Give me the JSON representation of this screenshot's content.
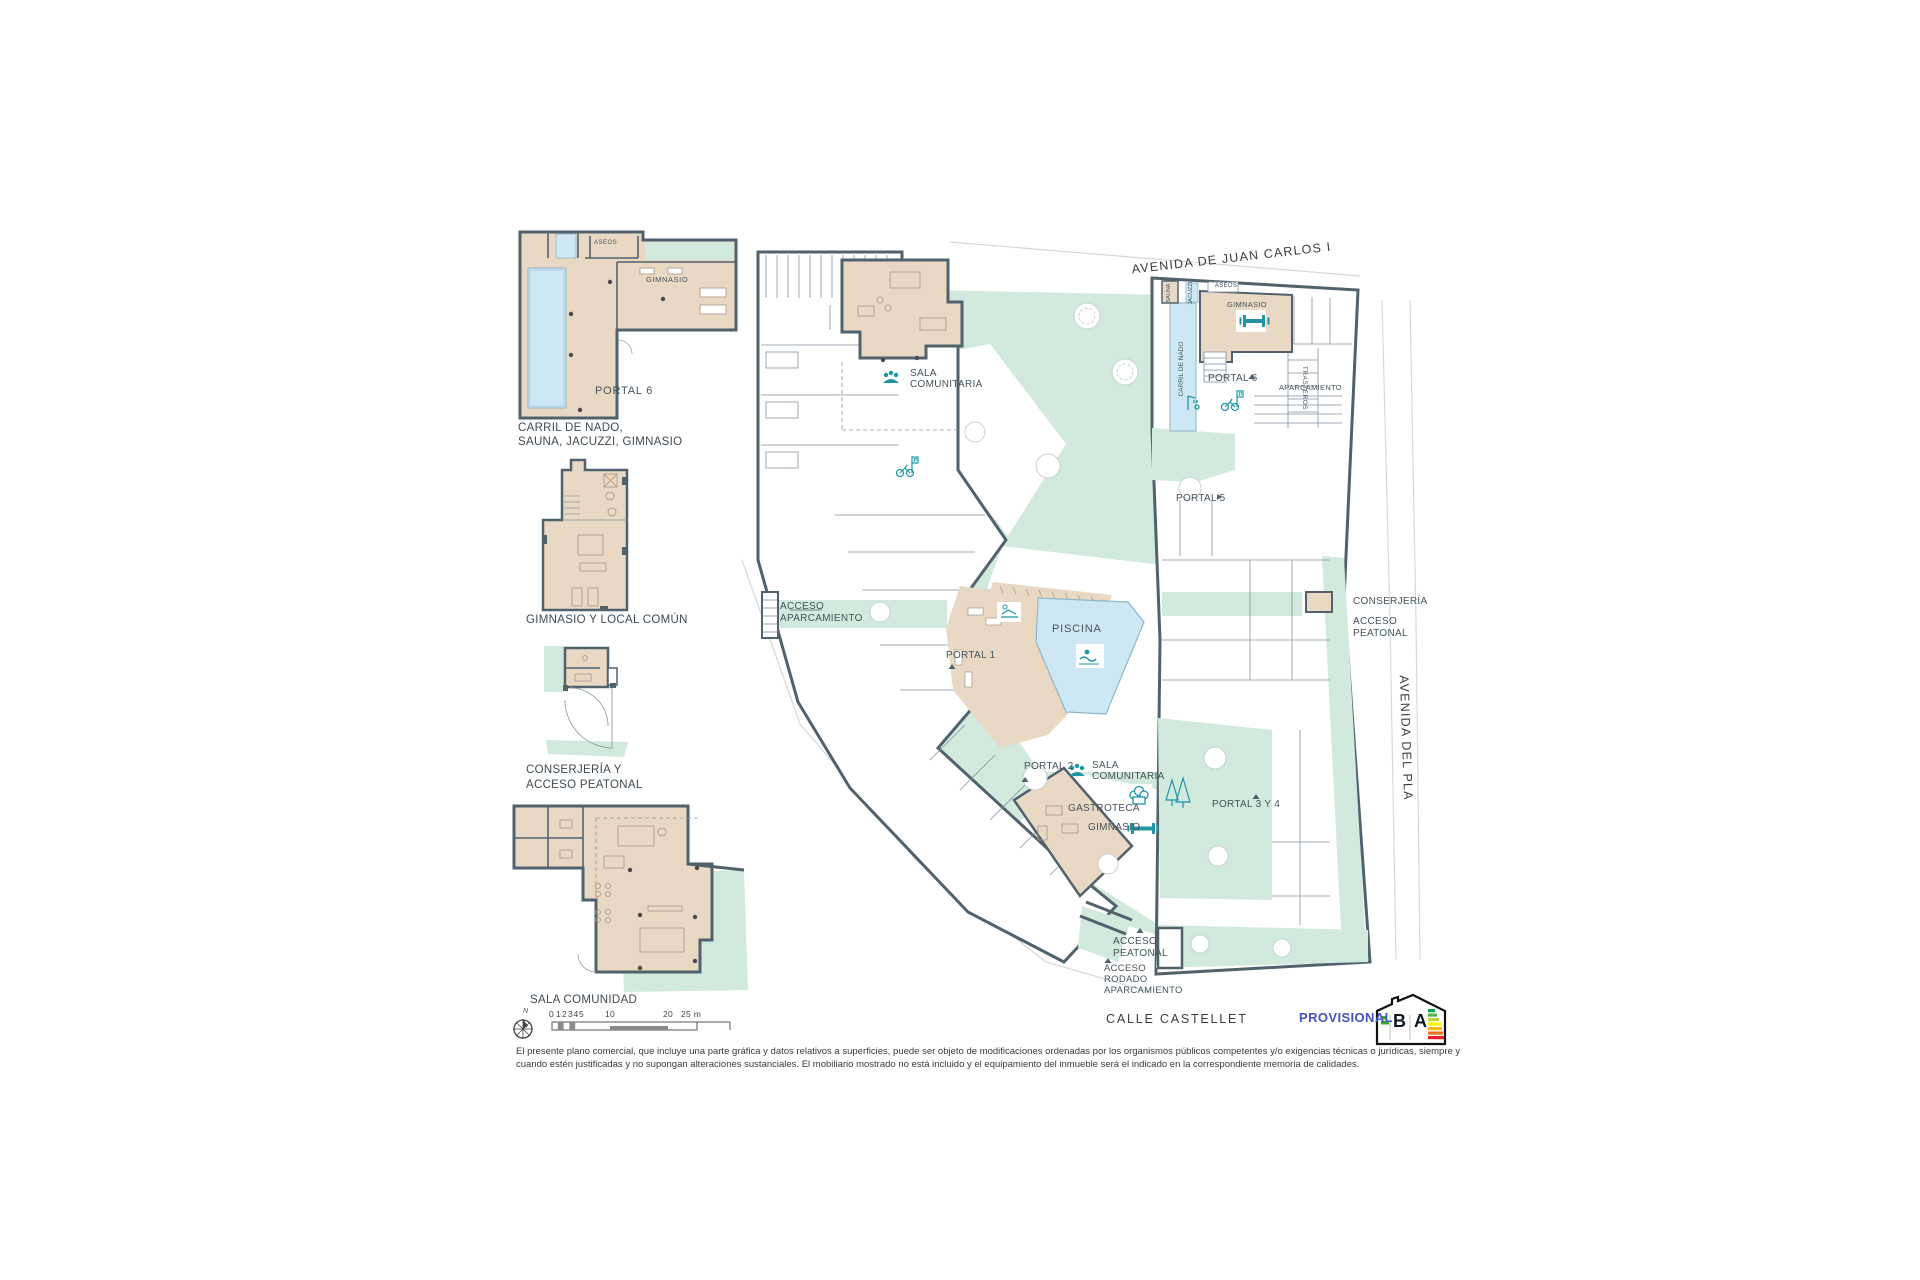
{
  "colors": {
    "wall": "#51626d",
    "floor_beige": "#e9d9c4",
    "landscape_teal": "#d2e9dd",
    "water_blue": "#cde8f4",
    "accent_teal": "#1f95a5",
    "provisional_blue": "#4653c4"
  },
  "streets": {
    "top": "AVENIDA DE JUAN CARLOS I",
    "right": "AVENIDA DEL PLA",
    "bottom": "CALLE CASTELLET"
  },
  "plan": {
    "piscina": "PISCINA",
    "sala_top": {
      "l1": "SALA",
      "l2": "COMUNITARIA"
    },
    "sala_center": {
      "l1": "SALA",
      "l2": "COMUNITARIA"
    },
    "acceso_aparcamiento": {
      "l1": "ACCESO",
      "l2": "APARCAMIENTO"
    },
    "portales": {
      "p1": "PORTAL 1",
      "p2": "PORTAL 2",
      "p34": "PORTAL 3 Y 4",
      "p5": "PORTAL 5",
      "p6": "PORTAL 6"
    },
    "gastroteca": "GASTROTECA",
    "gimnasio_center": "GIMNASIO",
    "ne": {
      "gimnasio": "GIMNASIO",
      "aseos": "ASEOS",
      "sauna": "SAUNA",
      "jacuzzi": "JACUZZI",
      "carril": "CARRIL DE NADO",
      "trasteros": "TRASTEROS",
      "aparcamiento": "APARCAMIENTO"
    },
    "east": {
      "conserjeria": "CONSERJERÍA",
      "acceso_l1": "ACCESO",
      "acceso_l2": "PEATONAL"
    },
    "south": {
      "acceso_l1": "ACCESO",
      "acceso_l2": "PEATONAL",
      "rodado_l1": "ACCESO",
      "rodado_l2": "RODADO",
      "rodado_l3": "APARCAMIENTO"
    },
    "bike_flag": "P"
  },
  "details": {
    "d1": {
      "sauna": "SAUNA",
      "jacuzzi": "JACUZZI",
      "aseos": "ASEOS",
      "gimnasio": "GIMNASIO",
      "carril": "CARRIL DE NADO",
      "portal": "PORTAL 6",
      "caption_l1": "CARRIL DE NADO,",
      "caption_l2": "SAUNA, JACUZZI, GIMNASIO"
    },
    "d2": {
      "caption": "GIMNASIO Y LOCAL COMÚN"
    },
    "d3": {
      "caption_l1": "CONSERJERÍA Y",
      "caption_l2": "ACCESO PEATONAL"
    },
    "d4": {
      "caption": "SALA COMUNIDAD"
    }
  },
  "scalebar": {
    "ticks": [
      "0",
      "1",
      "2",
      "3",
      "4",
      "5",
      "10",
      "20",
      "25 m"
    ],
    "north": "N"
  },
  "footer": {
    "disclaimer_l1": "El presente plano comercial, que incluye una parte gráfica y datos relativos a superficies, puede ser objeto de modificaciones ordenadas por los organismos públicos competentes y/o exigencias técnicas o jurídicas, siempre y",
    "disclaimer_l2": "cuando estén justificadas y no supongan alteraciones sustanciales. El mobiliario mostrado no está incluido y el equipamiento del inmueble será el indicado en la correspondiente memoria de calidades.",
    "provisional": "PROVISIONAL"
  },
  "energy": {
    "left": "B",
    "right": "A"
  },
  "icons": {
    "people-icon": "group of figures (community room)",
    "swimmer-icon": "swimmer (pool)",
    "lounger-icon": "sun lounger (solarium)",
    "chef-hat-icon": "chef hat (gastroteca)",
    "dumbbell-icon": "dumbbell (gym)",
    "bicycle-icon": "bicycle parking with P flag",
    "shower-icon": "pool shower",
    "pine-trees-icon": "two pine trees",
    "compass-icon": "north arrow compass",
    "energy-label-icon": "energy efficiency house logo B/A"
  }
}
